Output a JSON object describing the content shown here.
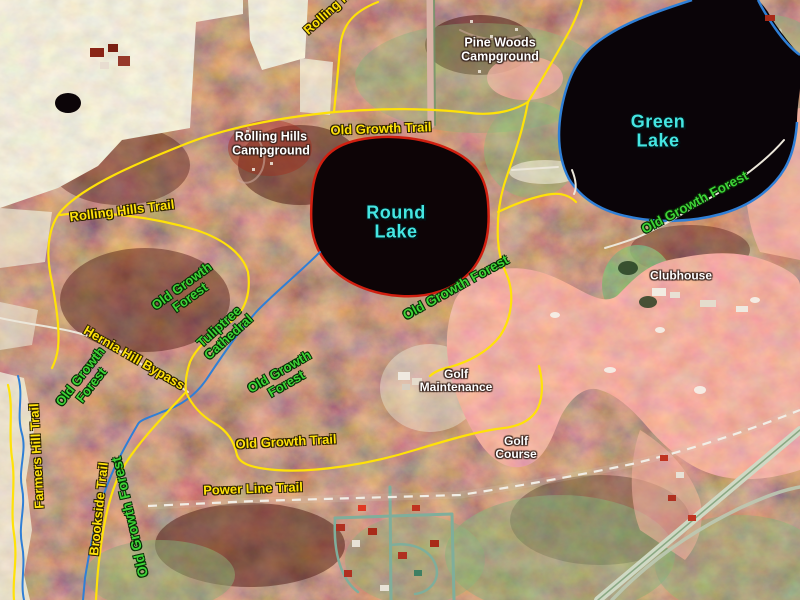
{
  "map": {
    "description": "False-color infrared aerial photograph of a park with lakes, trails, campgrounds and a golf course",
    "labels": {
      "green_lake": "Green Lake",
      "round_lake": "Round Lake",
      "pine_woods_campground": "Pine Woods Campground",
      "rolling_hills_campground": "Rolling Hills Campground",
      "rolling_hills_trail": "Rolling Hills Trail",
      "old_growth_trail": "Old Growth Trail",
      "old_growth_forest": "Old Growth Forest",
      "hernia_hill_bypass": "Hernia Hill Bypass",
      "tuliptree_cathedral": "Tuliptree Cathedral",
      "farmers_hill_trail": "Farmers Hill Trail",
      "brookside_trail": "Brookside Trail",
      "power_line_trail": "Power Line Trail",
      "golf_maintenance": "Golf Maintenance",
      "golf_course": "Golf Course",
      "clubhouse": "Clubhouse"
    },
    "colors": {
      "trail_line": "#ffe208",
      "trail_label": "#ffe20a",
      "forest_label": "#3fd437",
      "lake_label": "#45e6e2",
      "place_label": "#ffffff",
      "stream_line": "#2f7fd6",
      "round_lake_outline": "#d01f10",
      "green_lake_outline": "#2f7fd6",
      "power_line_dash": "#f2eee6"
    },
    "lakes": [
      {
        "name": "Round Lake",
        "outline": "red"
      },
      {
        "name": "Green Lake",
        "outline": "blue"
      }
    ]
  }
}
